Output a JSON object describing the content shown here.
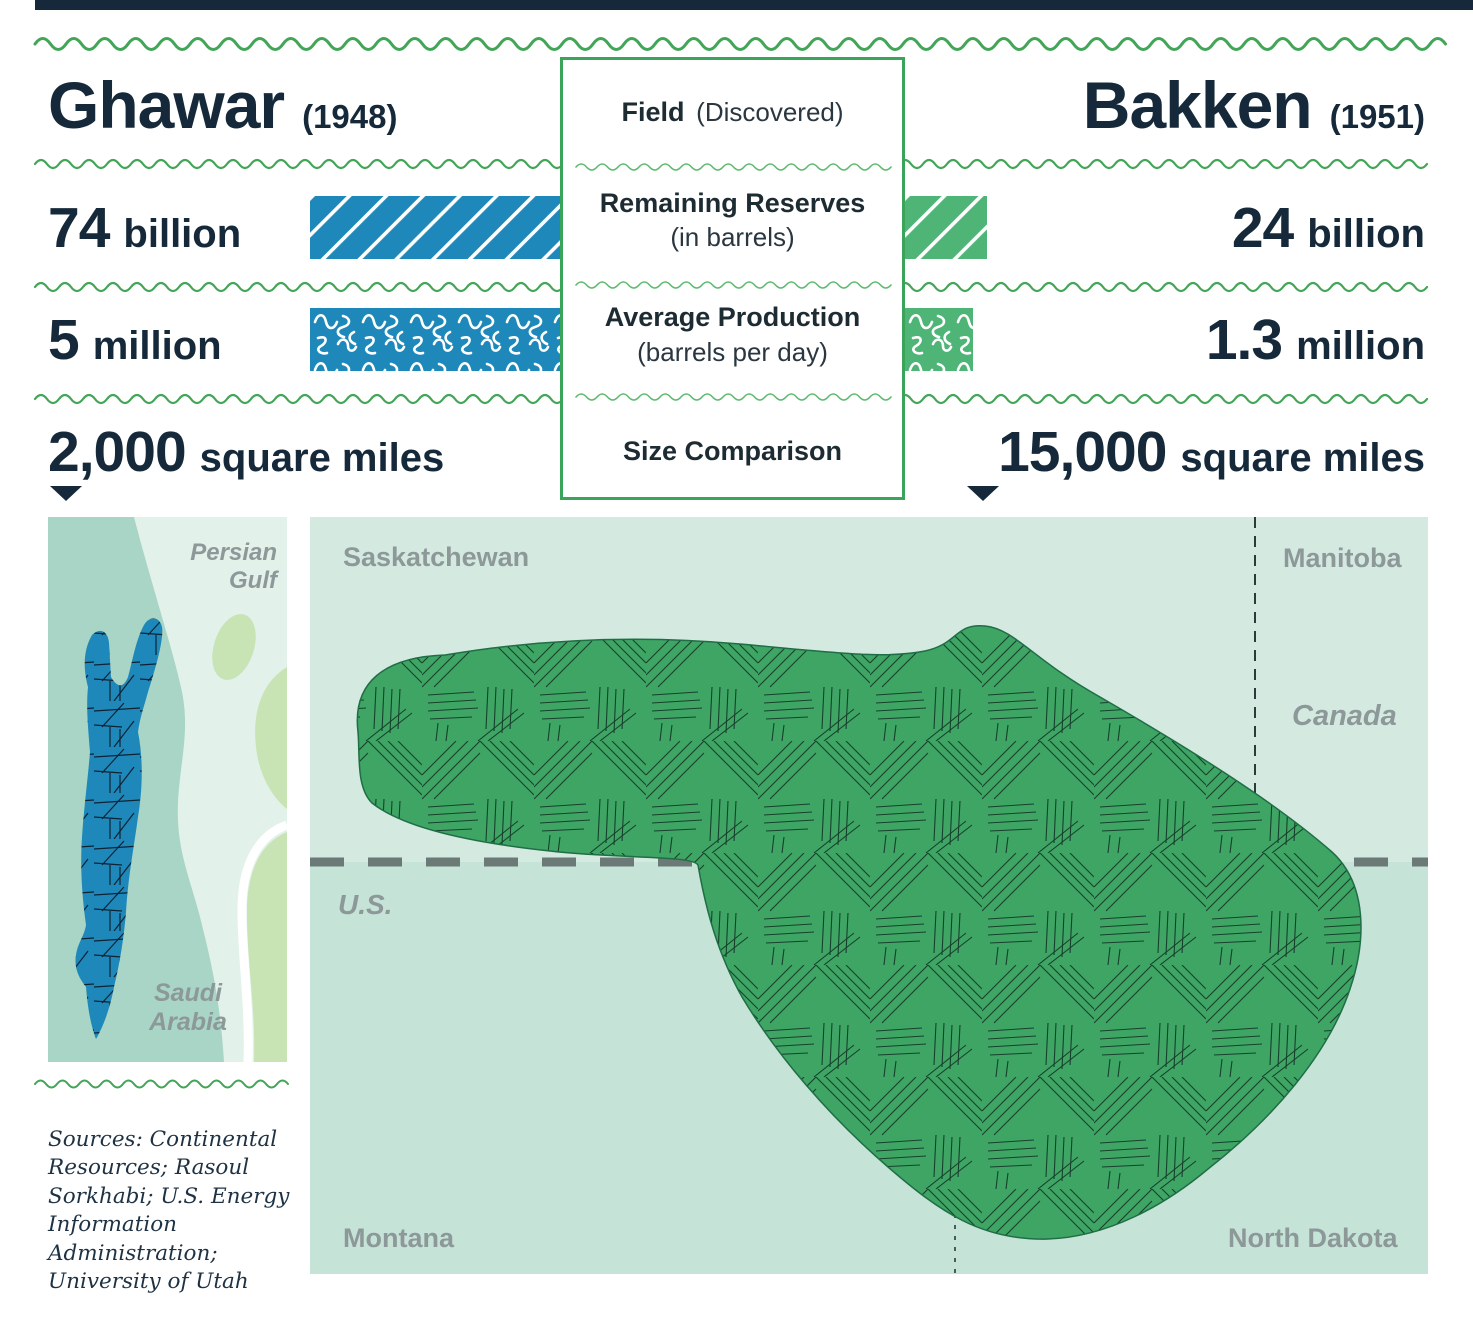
{
  "header": {
    "left_name": "Ghawar",
    "left_year": "(1948)",
    "center_bold": "Field",
    "center_norm": "(Discovered)",
    "right_name": "Bakken",
    "right_year": "(1951)"
  },
  "rows": {
    "reserves": {
      "label_bold": "Remaining Reserves",
      "label_sub": "(in barrels)",
      "left_num": "74",
      "left_unit": "billion",
      "right_num": "24",
      "right_unit": "billion"
    },
    "production": {
      "label_bold": "Average Production",
      "label_sub": "(barrels per day)",
      "left_num": "5",
      "left_unit": "million",
      "right_num": "1.3",
      "right_unit": "million"
    },
    "size": {
      "label_bold": "Size Comparison",
      "left_num": "2,000",
      "left_unit": "square miles",
      "right_num": "15,000",
      "right_unit": "square miles"
    }
  },
  "maps": {
    "ghawar": {
      "label_gulf": "Persian\nGulf",
      "label_country": "Saudi\nArabia"
    },
    "bakken": {
      "label_sask": "Saskatchewan",
      "label_manitoba": "Manitoba",
      "label_canada": "Canada",
      "label_us": "U.S.",
      "label_montana": "Montana",
      "label_nd": "North Dakota"
    }
  },
  "sources": "Sources: Continental Resources; Rasoul Sorkhabi; U.S. Energy Information Administration; University of Utah",
  "colors": {
    "navy": "#15293a",
    "accent_green": "#3aa55a",
    "wave_green": "#42a558",
    "wave_green_light": "#5fba70",
    "bar_blue": "#1e88ba",
    "bar_green": "#4eb577",
    "blob_green": "#3ea565",
    "hatch_dark": "#16402b",
    "hatch_blue_dark": "#0d2233",
    "gray_label": "#8d9899",
    "map_canada_bg": "#d4eae1",
    "map_us_bg": "#c5e3d7",
    "map_land": "#a8d5c5",
    "map_water": "#e2f1ea",
    "map_land_light": "#c8e3b4",
    "border_dash_gray": "#6b7a77",
    "border_dash_dark": "#2c3a3a"
  },
  "chart_data": {
    "type": "bar",
    "title": "Ghawar vs Bakken oil field comparison",
    "categories": [
      "Remaining Reserves (in barrels)",
      "Average Production (barrels per day)",
      "Size (square miles)"
    ],
    "series": [
      {
        "name": "Ghawar (1948)",
        "values": [
          74000000000,
          5000000,
          2000
        ],
        "display": [
          "74 billion",
          "5 million",
          "2,000 square miles"
        ],
        "color": "#1e88ba"
      },
      {
        "name": "Bakken (1951)",
        "values": [
          24000000000,
          1300000,
          15000
        ],
        "display": [
          "24 billion",
          "1.3 million",
          "15,000 square miles"
        ],
        "color": "#4eb577"
      }
    ],
    "legend_position": "none",
    "grid": false
  }
}
